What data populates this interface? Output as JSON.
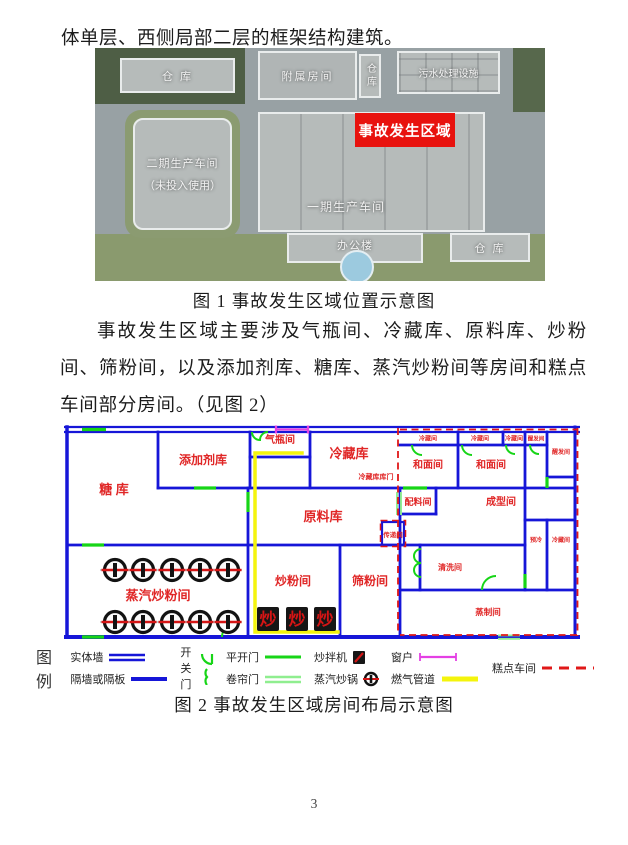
{
  "page": {
    "number": "3"
  },
  "body_text": {
    "line_top": "体单层、西侧局部二层的框架结构建筑。",
    "paragraph": "事故发生区域主要涉及气瓶间、冷藏库、原料库、炒粉间、筛粉间，以及添加剂库、糖库、蒸汽炒粉间等房间和糕点车间部分房间。（见图 2）"
  },
  "figure1": {
    "caption": "图 1  事故发生区域位置示意图",
    "labels": {
      "warehouse_tl": "仓 库",
      "annex": "附属房间",
      "warehouse_mid": "仓库",
      "sewage": "污水处理设施",
      "phase2_l1": "二期生产车间",
      "phase2_l2": "（未投入使用）",
      "phase1": "一期生产车间",
      "accident_area": "事故发生区域",
      "office": "办公楼",
      "warehouse_br": "仓 库"
    },
    "colors": {
      "accident_red": "#e8120e"
    }
  },
  "figure2": {
    "caption": "图 2  事故发生区域房间布局示意图",
    "colors": {
      "wall_blue": "#1616d8",
      "door_green": "#17d517",
      "shutter_green": "#8fee8f",
      "window_magenta": "#e440e4",
      "gas_yellow": "#f4f40c",
      "pastry_boundary_red": "#e01818",
      "room_label_red": "#e02626"
    },
    "rooms": [
      {
        "label": "糖 库"
      },
      {
        "label": "添加剂库"
      },
      {
        "label": "气瓶间"
      },
      {
        "label": "冷藏库"
      },
      {
        "label": "原料库"
      },
      {
        "label": "蒸汽炒粉间"
      },
      {
        "label": "炒粉间"
      },
      {
        "label": "筛粉间"
      },
      {
        "label": "冷藏间"
      },
      {
        "label": "冷藏间"
      },
      {
        "label": "冷藏间"
      },
      {
        "label": "醒发间"
      },
      {
        "label": "醒发间"
      },
      {
        "label": "和面间"
      },
      {
        "label": "和面间"
      },
      {
        "label": "冷藏库库门"
      },
      {
        "label": "配料间"
      },
      {
        "label": "成型间"
      },
      {
        "label": "传递间"
      },
      {
        "label": "清洗间"
      },
      {
        "label": "预冷"
      },
      {
        "label": "冷藏间"
      },
      {
        "label": "蒸制间"
      }
    ],
    "equipment": {
      "mixer_glyph": "炒"
    },
    "legend": {
      "title": "图例",
      "items": [
        {
          "label": "实体墙"
        },
        {
          "label": "隔墙或隔板"
        },
        {
          "label": "开关门"
        },
        {
          "label": "平开门"
        },
        {
          "label": "卷帘门"
        },
        {
          "label": "炒拌机"
        },
        {
          "label": "蒸汽炒锅"
        },
        {
          "label": "窗户"
        },
        {
          "label": "燃气管道"
        },
        {
          "label": "糕点车间"
        }
      ]
    }
  }
}
